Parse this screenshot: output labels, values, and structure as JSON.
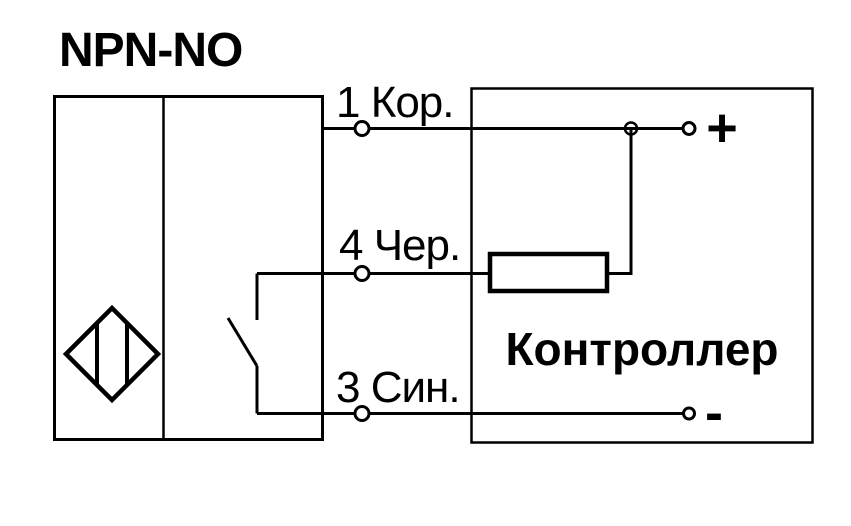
{
  "colors": {
    "line": "#000000",
    "background": "#ffffff"
  },
  "diagram": {
    "title": "NPN-NO",
    "wires": [
      {
        "label": "1 Кор."
      },
      {
        "label": "4 Чер."
      },
      {
        "label": "3 Син."
      }
    ],
    "controller": {
      "label": "Контроллер",
      "plus_terminal": "+",
      "minus_terminal": "-"
    },
    "icons": {
      "sensor_symbol": "inductive-proximity-diamond",
      "switch_symbol": "normally-open-contact",
      "load_symbol": "resistor"
    }
  }
}
